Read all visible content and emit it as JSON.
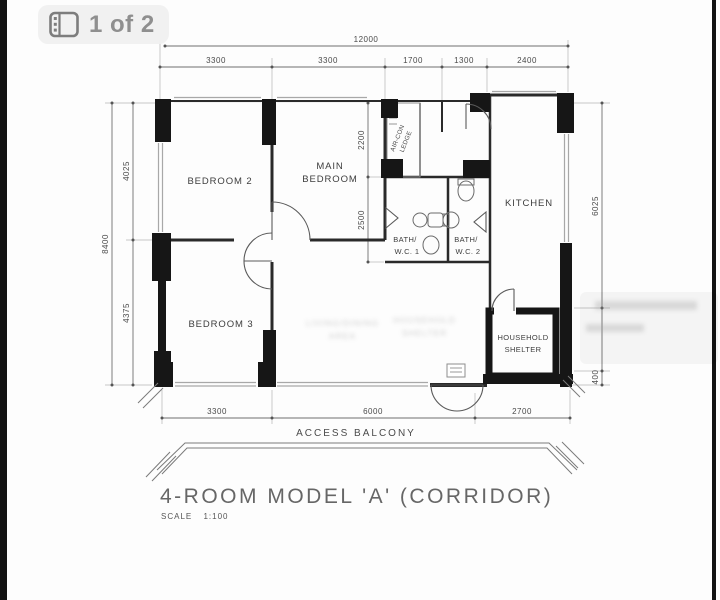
{
  "photo_viewer": {
    "counter_label": "1 of 2"
  },
  "floor_plan": {
    "title": "4-ROOM MODEL 'A' (CORRIDOR)",
    "scale": "SCALE 1:100",
    "rooms": {
      "bedroom2": "BEDROOM 2",
      "main_bedroom_1": "MAIN",
      "main_bedroom_2": "BEDROOM",
      "bedroom3": "BEDROOM 3",
      "kitchen": "KITCHEN",
      "bath1_1": "BATH/",
      "bath1_2": "W.C. 1",
      "bath2_1": "BATH/",
      "bath2_2": "W.C. 2",
      "shelter_1": "HOUSEHOLD",
      "shelter_2": "SHELTER",
      "aircon_1": "AIR-CON",
      "aircon_2": "LEDGE",
      "access_balcony": "ACCESS BALCONY"
    },
    "dimensions": {
      "top_overall": "12000",
      "top_segments": [
        "3300",
        "3300",
        "1700",
        "1300",
        "2400"
      ],
      "left_overall": "8400",
      "left_segments": [
        "4025",
        "4375"
      ],
      "inner_segments": [
        "2200",
        "2500"
      ],
      "right_segments": [
        "6025",
        "400"
      ],
      "bottom_segments": [
        "3300",
        "6000",
        "2700"
      ]
    },
    "watermark": {
      "ghost_a_1": "LIVING/DINING",
      "ghost_a_2": "AREA",
      "ghost_b_1": "HOUSEHOLD",
      "ghost_b_2": "SHELTER"
    }
  }
}
